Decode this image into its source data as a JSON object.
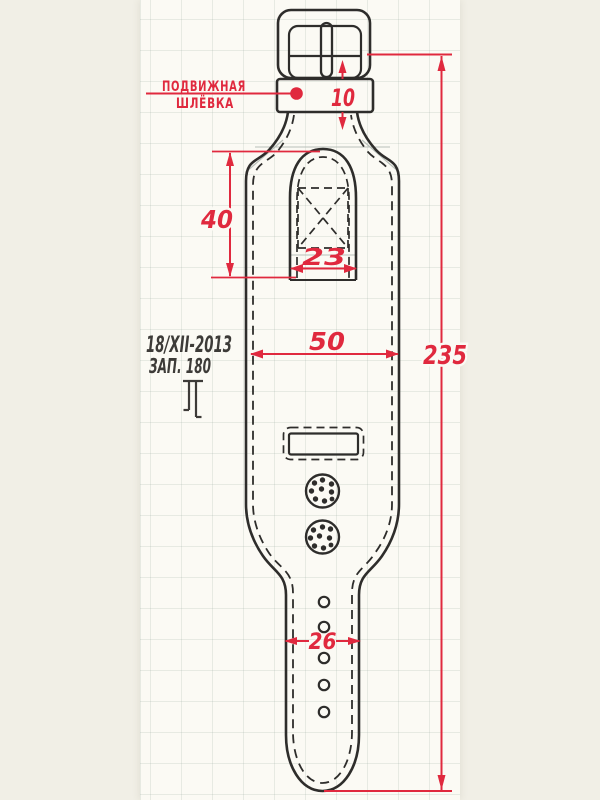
{
  "drawing": {
    "subject": "watch strap cuff pattern, hand-drawn technical sketch on graph paper",
    "keeper_label": {
      "line1": "ПОДВИЖНАЯ",
      "line2": "ШЛЁВКА"
    },
    "notes": {
      "date": "18/XII-2013",
      "order": "ЗАП. 180"
    },
    "dimensions": {
      "keeper_height": "10",
      "tab_height": "40",
      "tab_width": "23",
      "cuff_width": "50",
      "total_length": "235",
      "strap_end_width": "26"
    },
    "colors": {
      "dimension_red": "#e0293e",
      "ink": "#2e2d2b",
      "note_ink": "#3d3b38",
      "pencil": "#b9c0ba",
      "paper": "#fbfaf4",
      "background": "#f1efe6"
    }
  }
}
